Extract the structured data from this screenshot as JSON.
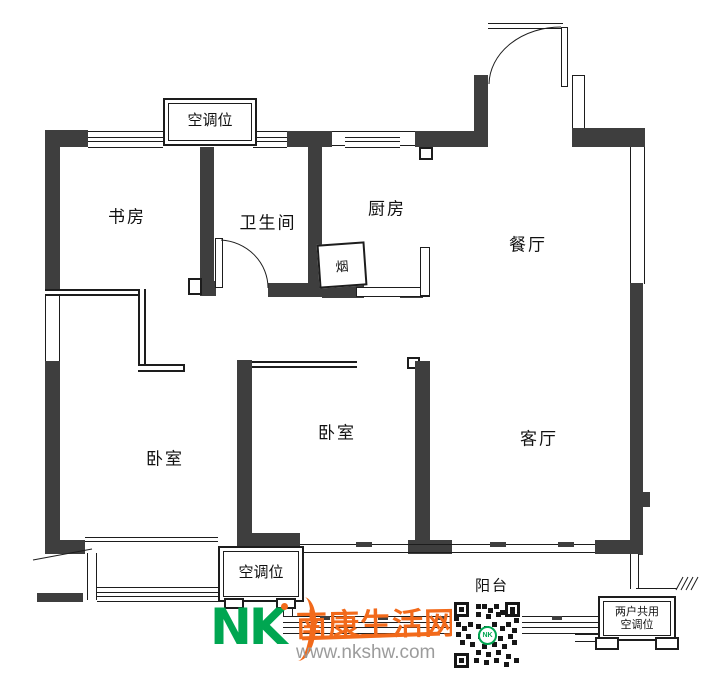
{
  "page": {
    "type": "apartment-floor-plan"
  },
  "rooms": {
    "study": "书房",
    "bathroom": "卫生间",
    "kitchen": "厨房",
    "dining": "餐厅",
    "living": "客厅",
    "bedroom_left": "卧室",
    "bedroom_middle": "卧室",
    "balcony": "阳台"
  },
  "annotations": {
    "flue": "烟",
    "ac_top": "空调位",
    "ac_bottom_left": "空调位",
    "ac_shared_line1": "两户共用",
    "ac_shared_line2": "空调位"
  },
  "watermark": {
    "logo_text": "NK",
    "site_name": "南康生活网",
    "url": "www.nkshw.com",
    "qr_center_text": "NK",
    "brand_green": "#00a651",
    "brand_orange": "#f26a1b",
    "wall_color": "#3e3e3e"
  }
}
